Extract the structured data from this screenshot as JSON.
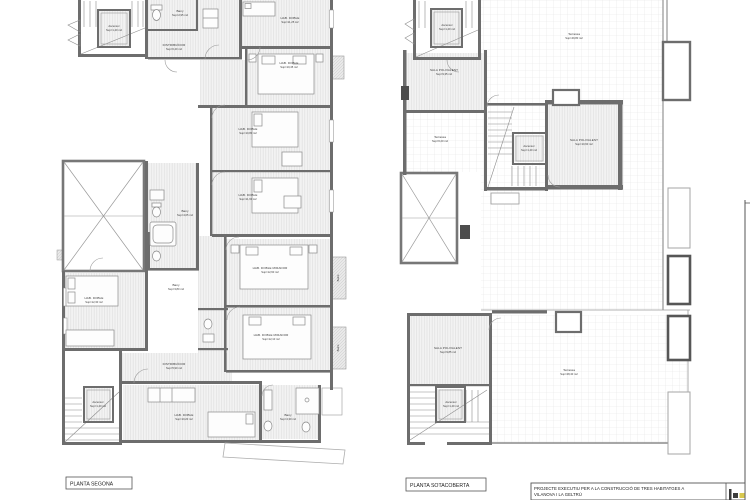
{
  "captions": {
    "left": "PLANTA SEGONA",
    "right": "PLANTA SOTACOBERTA"
  },
  "title_block": {
    "project_line1": "PROJECTE EXECUTIU PER A LA CONSTRUCCIÓ DE TRES HABITATGES A",
    "project_line2": "VILANOVA I LA GELTRÚ",
    "logo_accent_color": "#d8c84e",
    "logo_dark_color": "#3c3c3c"
  },
  "plan_segona": {
    "labels": {
      "ascensor_top": {
        "l1": "Ascensor",
        "l2": "Sup=1,40 m2"
      },
      "bany_top": {
        "l1": "Bany",
        "l2": "Sup=2,95 m2"
      },
      "hab_top": {
        "l1": "HAB. DOBLE",
        "l2": "Sup=11,25 m2"
      },
      "distribuidor_top": {
        "l1": "DISTRIBUÏDOR",
        "l2": "Sup=6,40 m2"
      },
      "hab_mid_dreta": {
        "l1": "HAB. DOBLE",
        "l2": "Sup=10,45 m2"
      },
      "hab_mid1": {
        "l1": "HAB. DOBLE",
        "l2": "Sup=10,80 m2"
      },
      "hab_mid2": {
        "l1": "HAB. DOBLE",
        "l2": "Sup=11,60 m2"
      },
      "bany_mid": {
        "l1": "Bany",
        "l2": "Sup=4,05 m2"
      },
      "hab_esquerra": {
        "l1": "HAB. DOBLE",
        "l2": "Sup=12,30 m2"
      },
      "bany_esquerra": {
        "l1": "Bany",
        "l2": "Sup=3,80 m2"
      },
      "hab_mirador1": {
        "l1": "HAB. DOBLE MIRADOR",
        "l2": "Sup=12,60 m2"
      },
      "hab_mirador2": {
        "l1": "HAB. DOBLE MIRADOR",
        "l2": "Sup=12,10 m2"
      },
      "distribuidor_baix": {
        "l1": "DISTRIBUÏDOR",
        "l2": "Sup=5,90 m2"
      },
      "hab_baix": {
        "l1": "HAB. DOBLE",
        "l2": "Sup=10,20 m2"
      },
      "bany_baix": {
        "l1": "Bany",
        "l2": "Sup=4,30 m2"
      },
      "ascensor_baix": {
        "l1": "Ascensor",
        "l2": "Sup=1,40 m2"
      },
      "balco1": {
        "l1": "Balcó"
      },
      "balco2": {
        "l1": "Balcó"
      }
    }
  },
  "plan_sotacoberta": {
    "labels": {
      "ascensor_top": {
        "l1": "Ascensor",
        "l2": "Sup=1,40 m2"
      },
      "sala_top": {
        "l1": "SALA POLIVALENT",
        "l2": "Sup=9,35 m2"
      },
      "terrassa_gran": {
        "l1": "Terrassa",
        "l2": "Sup=49,80 m2"
      },
      "terrassa_esq": {
        "l1": "Terrassa",
        "l2": "Sup=6,20 m2"
      },
      "ascensor_mid": {
        "l1": "Ascensor",
        "l2": "Sup=1,40 m2"
      },
      "sala_mid": {
        "l1": "SALA POLIVALENT",
        "l2": "Sup=10,60 m2"
      },
      "sala_baix": {
        "l1": "SALA POLIVALENT",
        "l2": "Sup=9,85 m2"
      },
      "ascensor_baix": {
        "l1": "Ascensor",
        "l2": "Sup=1,40 m2"
      },
      "terrassa_baix": {
        "l1": "Terrassa",
        "l2": "Sup=28,40 m2"
      }
    }
  }
}
